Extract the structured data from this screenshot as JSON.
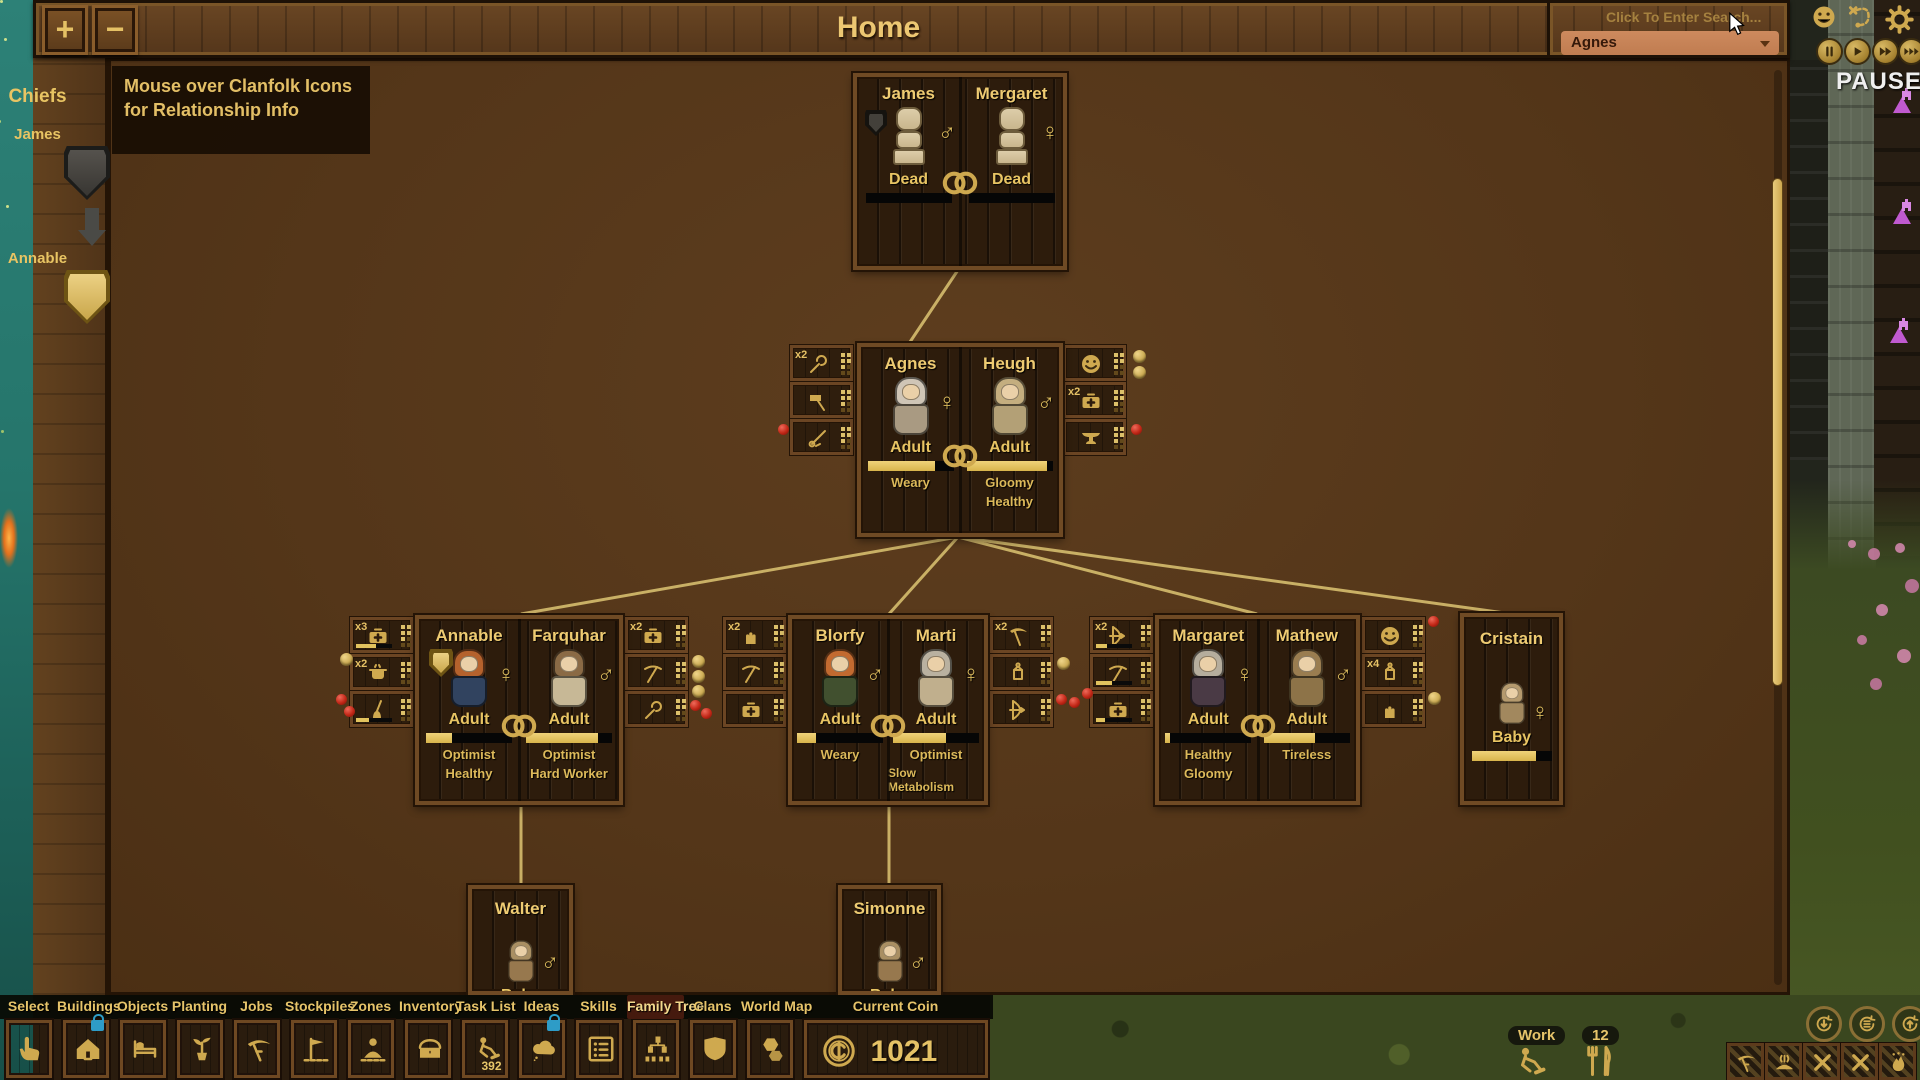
{
  "topbar": {
    "title": "Home",
    "zoom_in_label": "+",
    "zoom_out_label": "−",
    "search_placeholder": "Click To Enter Search...",
    "person_dropdown_value": "Agnes"
  },
  "status": {
    "paused_label": "PAUSED"
  },
  "chiefs_panel": {
    "title": "Chiefs",
    "chiefs": [
      {
        "name": "James"
      },
      {
        "name": "Annable"
      }
    ]
  },
  "hint_tooltip": "Mouse over Clanfolk Icons for Relationship Info",
  "family_tree": {
    "gen1": {
      "left": {
        "name": "James",
        "gender_symbol": "♂",
        "stage": "Dead",
        "bar": 0
      },
      "right": {
        "name": "Mergaret",
        "gender_symbol": "♀",
        "stage": "Dead",
        "bar": 0
      }
    },
    "gen2": {
      "left": {
        "name": "Agnes",
        "gender_symbol": "♀",
        "stage": "Adult",
        "bar": 78,
        "traits": [
          "Weary"
        ],
        "hood": "#cfc5b6",
        "robe": "#a99a82"
      },
      "right": {
        "name": "Heugh",
        "gender_symbol": "♂",
        "stage": "Adult",
        "bar": 94,
        "traits": [
          "Gloomy",
          "Healthy"
        ],
        "hood": "#c4ae7f",
        "robe": "#b3a076"
      },
      "left_icons": [
        {
          "count": "x2",
          "icon": "wrench"
        },
        {
          "icon": "hammer"
        },
        {
          "icon": "needle"
        }
      ],
      "right_icons": [
        {
          "icon": "smiley"
        },
        {
          "count": "x2",
          "icon": "medkit"
        },
        {
          "icon": "anvil"
        }
      ]
    },
    "gen3": [
      {
        "left": {
          "name": "Annable",
          "gender_symbol": "♀",
          "stage": "Adult",
          "bar": 30,
          "traits": [
            "Optimist",
            "Healthy"
          ],
          "hood": "#b5622d",
          "robe": "#31435f"
        },
        "right": {
          "name": "Farquhar",
          "gender_symbol": "♂",
          "stage": "Adult",
          "bar": 84,
          "traits": [
            "Optimist",
            "Hard Worker"
          ],
          "hood": "#8a6a45",
          "robe": "#c7b896"
        },
        "left_icons": [
          {
            "count": "x3",
            "icon": "medkit",
            "bar": 55
          },
          {
            "count": "x2",
            "icon": "pot"
          },
          {
            "icon": "broom",
            "bar": 35
          }
        ],
        "right_icons": [
          {
            "count": "x2",
            "icon": "medkit"
          },
          {
            "icon": "pickaxe"
          },
          {
            "icon": "wrench"
          }
        ]
      },
      {
        "left": {
          "name": "Blorfy",
          "gender_symbol": "♂",
          "stage": "Adult",
          "bar": 22,
          "traits": [
            "Weary"
          ],
          "hood": "#c26a30",
          "robe": "#41502f"
        },
        "right": {
          "name": "Marti",
          "gender_symbol": "♀",
          "stage": "Adult",
          "bar": 62,
          "traits": [
            "Optimist",
            "Slow Metabolism"
          ],
          "hood": "#b9b1a0",
          "robe": "#c0af8d"
        },
        "left_icons": [
          {
            "count": "x2",
            "icon": "glove"
          },
          {
            "icon": "pickaxe"
          },
          {
            "icon": "medkit"
          }
        ],
        "right_icons": [
          {
            "count": "x2",
            "icon": "scythe"
          },
          {
            "icon": "lantern"
          },
          {
            "icon": "bow"
          }
        ]
      },
      {
        "left": {
          "name": "Margaret",
          "gender_symbol": "♀",
          "stage": "Adult",
          "bar": 6,
          "traits": [
            "Healthy",
            "Gloomy"
          ],
          "hood": "#b5ad9d",
          "robe": "#4a3a45"
        },
        "right": {
          "name": "Mathew",
          "gender_symbol": "♂",
          "stage": "Adult",
          "bar": 60,
          "traits": [
            "Tireless"
          ],
          "hood": "#9a7d50",
          "robe": "#8d7348"
        },
        "left_icons": [
          {
            "count": "x2",
            "icon": "bow",
            "bar": 30
          },
          {
            "icon": "pickaxe",
            "bar": 45
          },
          {
            "icon": "medkit",
            "bar": 25
          }
        ],
        "right_icons": [
          {
            "icon": "smiley"
          },
          {
            "count": "x4",
            "icon": "lantern"
          },
          {
            "icon": "glove"
          }
        ]
      }
    ],
    "gen3_single": {
      "name": "Cristain",
      "gender_symbol": "♀",
      "stage": "Baby",
      "bar": 80,
      "hood": "#b59a6e",
      "robe": "#a2885e"
    },
    "gen4": [
      {
        "name": "Walter",
        "gender_symbol": "♂",
        "stage": "Baby",
        "hood": "#a98f63",
        "robe": "#97784e"
      },
      {
        "name": "Simonne",
        "gender_symbol": "♂",
        "stage": "Baby",
        "hood": "#a98f63",
        "robe": "#97784e"
      }
    ]
  },
  "toolbar": {
    "tabs": [
      {
        "label": "Select"
      },
      {
        "label": "Buildings",
        "locked": true
      },
      {
        "label": "Objects"
      },
      {
        "label": "Planting"
      },
      {
        "label": "Jobs"
      },
      {
        "label": "Stockpiles"
      },
      {
        "label": "Zones"
      },
      {
        "label": "Inventory"
      },
      {
        "label": "Task List",
        "count": "392"
      },
      {
        "label": "Ideas",
        "locked": true
      },
      {
        "label": "Skills"
      },
      {
        "label": "Family Tree",
        "active": true
      },
      {
        "label": "Clans"
      },
      {
        "label": "World Map"
      },
      {
        "label": "Current Coin",
        "value": "1021"
      }
    ]
  },
  "hud": {
    "work_label": "Work",
    "food_count": "12"
  },
  "colors": {
    "accent_gold": "#e6c46a",
    "dropdown": "#c8825a",
    "paused": "#efefef"
  }
}
